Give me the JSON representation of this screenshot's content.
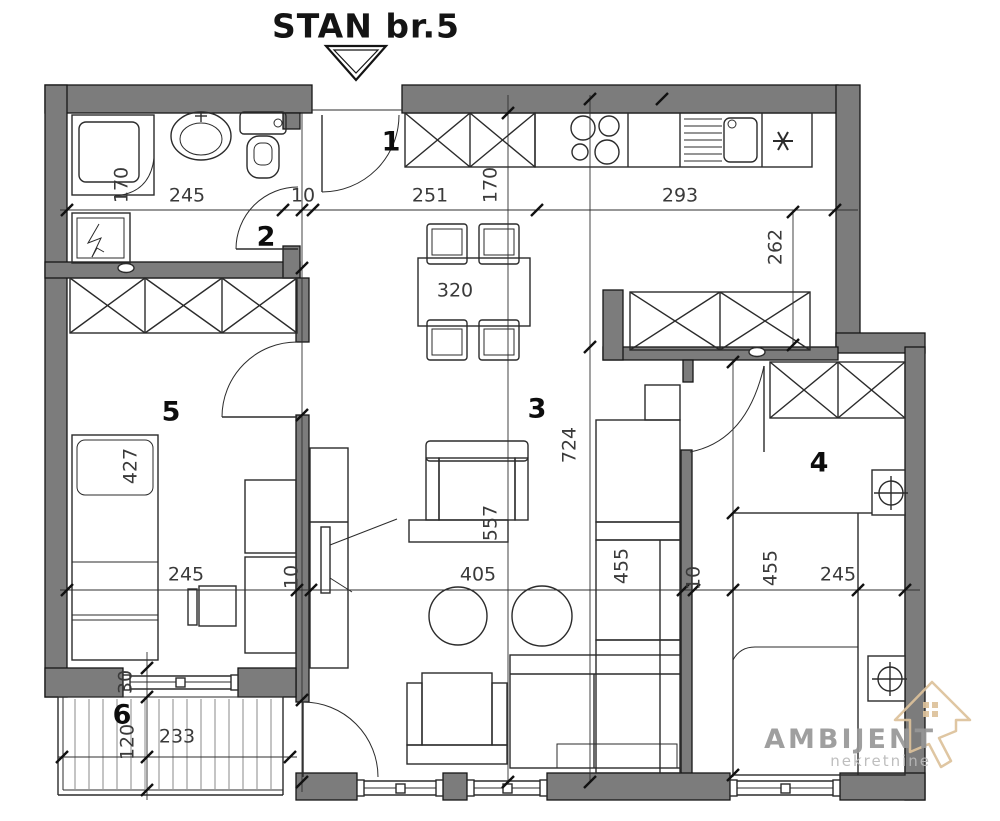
{
  "title": "STAN br.5",
  "rooms": [
    {
      "number": "1"
    },
    {
      "number": "2"
    },
    {
      "number": "3"
    },
    {
      "number": "4"
    },
    {
      "number": "5"
    },
    {
      "number": "6"
    }
  ],
  "dims": {
    "bath_depth": "170",
    "bath_width": "245",
    "bath_door": "10",
    "hall_width": "251",
    "hall_depth": "170",
    "kitchen_width": "293",
    "kitchen_depth": "262",
    "dining_table": "320",
    "living_depth": "724",
    "armchair_depth": "557",
    "living_width": "405",
    "cabinet_run": "455",
    "wall_a": "10",
    "bed4_length": "455",
    "room4_width": "245",
    "bed5_length": "427",
    "room5_width": "245",
    "wall_b": "10",
    "parapet": "30",
    "balcony_depth": "120",
    "balcony_width": "233"
  },
  "logo": {
    "name": "AMBIJENT",
    "tagline": "nekretnine"
  },
  "colors": {
    "wall": "#7c7c7c",
    "line": "#1a1a1a",
    "dimension_text": "#3a3a3a",
    "logo_text": "#979797",
    "logo_tagline": "#b9b9b9",
    "logo_icon": "#ddc29b",
    "background": "#ffffff"
  }
}
